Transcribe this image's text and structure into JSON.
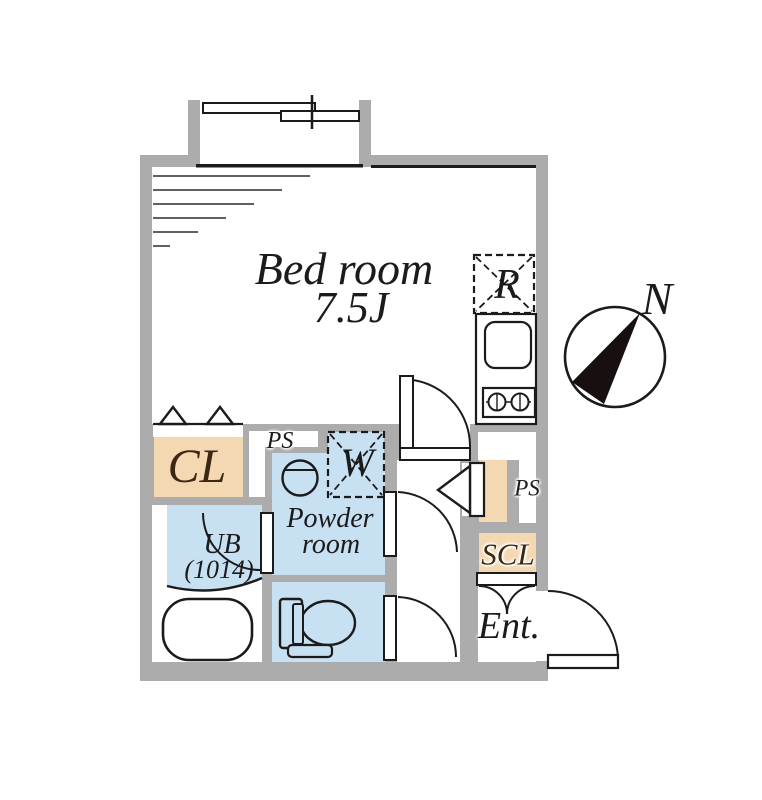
{
  "floorplan": {
    "compass": {
      "label": "N"
    },
    "rooms": {
      "bedroom": {
        "name": "Bed room",
        "size": "7.5J"
      },
      "refrigerator": {
        "label": "R"
      },
      "closet": {
        "label": "CL"
      },
      "pipe_space_1": {
        "label": "PS"
      },
      "washer": {
        "label": "W"
      },
      "powder_room": {
        "name_line1": "Powder",
        "name_line2": "room"
      },
      "unit_bath": {
        "name_line1": "UB",
        "name_line2": "(1014)"
      },
      "pipe_space_2": {
        "label": "PS"
      },
      "shoe_closet": {
        "label": "SCL"
      },
      "entrance": {
        "label": "Ent."
      }
    },
    "icons": {
      "compass": "north-compass-icon",
      "window": "sliding-window-icon",
      "sink": "kitchen-sink-icon",
      "stove": "two-burner-stove-icon",
      "basin": "wash-basin-icon",
      "bathtub": "bathtub-icon",
      "toilet": "toilet-icon"
    },
    "colors": {
      "wall": "#acacac",
      "tan": "#f3d8b2",
      "blue": "#c7e0f2",
      "line": "#1b1b1b",
      "label_dark": "#3a2714"
    }
  }
}
